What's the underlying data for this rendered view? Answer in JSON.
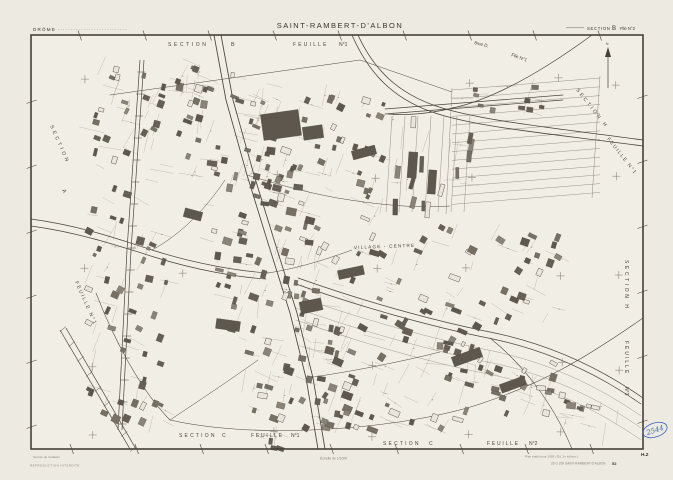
{
  "header": {
    "department": "DRÔME",
    "title": "SAINT-RAMBERT-D'ALBON",
    "sheet_section": "SECTION",
    "sheet_letter": "B",
    "sheet_folio": "Flle N°2"
  },
  "map_labels": {
    "top_section_word": "SECTION",
    "top_section_letter": "B",
    "top_feuille_word": "FEUILLE",
    "top_feuille_num": "N°1",
    "district": "8me D.",
    "district_folio": "Flle N°1",
    "north": "N",
    "ne_section": "SECTION  H",
    "ne_feuille": "FEUILLE  N°1",
    "east_section": "SECTION  H",
    "east_feuille": "FEUILLE",
    "east_num": "N°3",
    "west_section": "SECTION",
    "west_letter": "A",
    "west_feuille": "FEUILLE  N°1",
    "village": "VILLAGE - CENTRE",
    "south1_section": "SECTION",
    "south1_letter": "C",
    "south1_feuille": "FEUILLE",
    "south1_num": "N°1",
    "south2_section": "SECTION",
    "south2_letter": "C",
    "south2_feuille": "FEUILLE",
    "south2_num": "N°2",
    "corner_code": "H.2"
  },
  "footer": {
    "service_line1": "Service du Cadastre",
    "service_line2": "REPRODUCTION INTERDITE",
    "scale": "Échelle de 1/1000",
    "edition_note": "Plan établi pour 1955 ( Éd. 2e édition )",
    "reference": "26 O 269 SAINT-RAMBERT-D'ALBON",
    "reference_num": "52"
  },
  "annotation": {
    "handwritten_number": "2544"
  },
  "colors": {
    "paper": "#edeae2",
    "paper_light": "#f1eee6",
    "ink": "#4a453c",
    "ink_strong": "#38342d",
    "ink_faint": "#8d887d",
    "building_dark": "#5d574d",
    "building_mid": "#766f64",
    "building_light": "#8a8478",
    "hollow": "#e9e5dc",
    "blue": "#3a5fc0"
  }
}
